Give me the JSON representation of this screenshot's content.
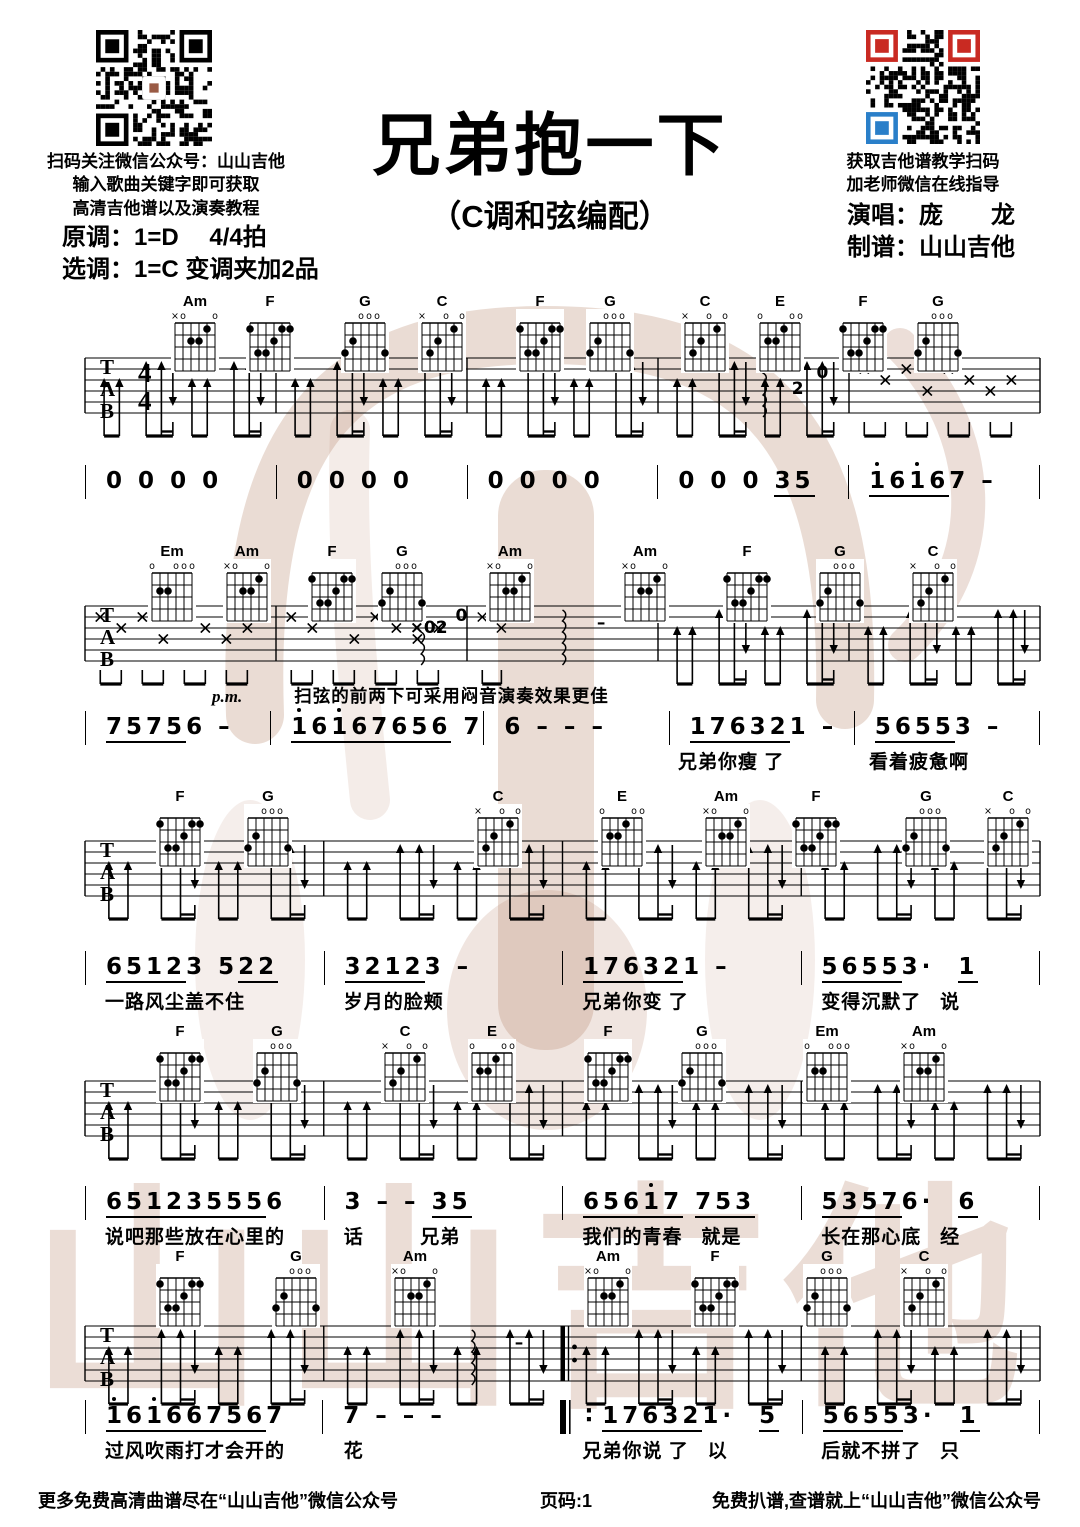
{
  "header": {
    "title": "兄弟抱一下",
    "subtitle": "（C调和弦编配）",
    "left_qr_caption": [
      "扫码关注微信公众号：山山吉他",
      "输入歌曲关键字即可获取",
      "高清吉他谱以及演奏教程"
    ],
    "key_info": [
      "原调：1=D　 4/4拍",
      "选调：1=C 变调夹加2品"
    ],
    "right_qr_caption": [
      "获取吉他谱教学扫码",
      "加老师微信在线指导"
    ],
    "credits": [
      "演唱：庞　　龙",
      "制谱：山山吉他"
    ]
  },
  "staff": {
    "tab_labels": [
      "T",
      "A",
      "B"
    ],
    "time_sig": [
      "4",
      "4"
    ]
  },
  "annotations": {
    "palm_mute": "p.m.",
    "tip": "扫弦的前两下可采用闷音演奏效果更佳"
  },
  "systems": [
    {
      "chords": [
        "Am",
        "F",
        "G",
        "C",
        "F",
        "G",
        "C",
        "E",
        "F",
        "G"
      ],
      "marks": [
        "2",
        "0"
      ],
      "measures": [
        {
          "num": "0 0 0 0",
          "lyric": ""
        },
        {
          "num": "0 0 0 0",
          "lyric": ""
        },
        {
          "num": "0 0 0 0",
          "lyric": ""
        },
        {
          "num": "0 0 0 _35_",
          "lyric": ""
        },
        {
          "num": "_'16__'16_7 –",
          "lyric": ""
        }
      ]
    },
    {
      "chords": [
        "Em",
        "Am",
        "F",
        "G",
        "Am",
        "Am",
        "F",
        "G",
        "C"
      ],
      "marks": [
        "×02",
        "0",
        "–"
      ],
      "measures": [
        {
          "num": "_7575_6 –",
          "lyric": ""
        },
        {
          "num": "_'16__'16__7656_ 7",
          "lyric": ""
        },
        {
          "num": "6 – – –",
          "lyric": ""
        },
        {
          "num": "_176__32_1 –",
          "lyric": "兄弟你瘦 了"
        },
        {
          "num": "_5655_3 –",
          "lyric": "看着疲惫啊"
        }
      ]
    },
    {
      "chords": [
        "F",
        "G",
        "C",
        "E",
        "Am",
        "F",
        "G",
        "C"
      ],
      "marks": [],
      "measures": [
        {
          "num": "_6512_3 5_22_",
          "lyric": "一路风尘盖不住"
        },
        {
          "num": "_3212_3 –",
          "lyric": "岁月的脸颊"
        },
        {
          "num": "_176__32_1 –",
          "lyric": "兄弟你变 了"
        },
        {
          "num": "_5655_3·  _1_",
          "lyric": "变得沉默了   说"
        }
      ]
    },
    {
      "chords": [
        "F",
        "G",
        "C",
        "E",
        "F",
        "G",
        "Em",
        "Am"
      ],
      "marks": [],
      "measures": [
        {
          "num": "_6512__3555_6",
          "lyric": "说吧那些放在心里的"
        },
        {
          "num": "3 – – _35_",
          "lyric": "话         兄弟"
        },
        {
          "num": "_656__'17_ _753_",
          "lyric": "我们的青春   就是"
        },
        {
          "num": "_5357_6·  _6_",
          "lyric": "长在那心底   经"
        }
      ]
    },
    {
      "chords": [
        "F",
        "G",
        "Am",
        "Am",
        "F",
        "G",
        "C"
      ],
      "marks": [
        "–"
      ],
      "measures": [
        {
          "num": "_'16'16__6756_7",
          "lyric": "过风吹雨打才会开的"
        },
        {
          "num": "7 – – –",
          "lyric": "花"
        },
        {
          "num": "_176__32_1·  _5_",
          "lyric": "兄弟你说 了   以",
          "repeat_before": true
        },
        {
          "num": "_5655_3·  _1_",
          "lyric": "后就不拼了   只"
        }
      ]
    }
  ],
  "footer": {
    "left": "更多免费高清曲谱尽在“山山吉他”微信公众号",
    "center": "页码:1",
    "right": "免费扒谱,查谱就上“山山吉他”微信公众号"
  },
  "watermark": {
    "text": "山山吉他"
  }
}
